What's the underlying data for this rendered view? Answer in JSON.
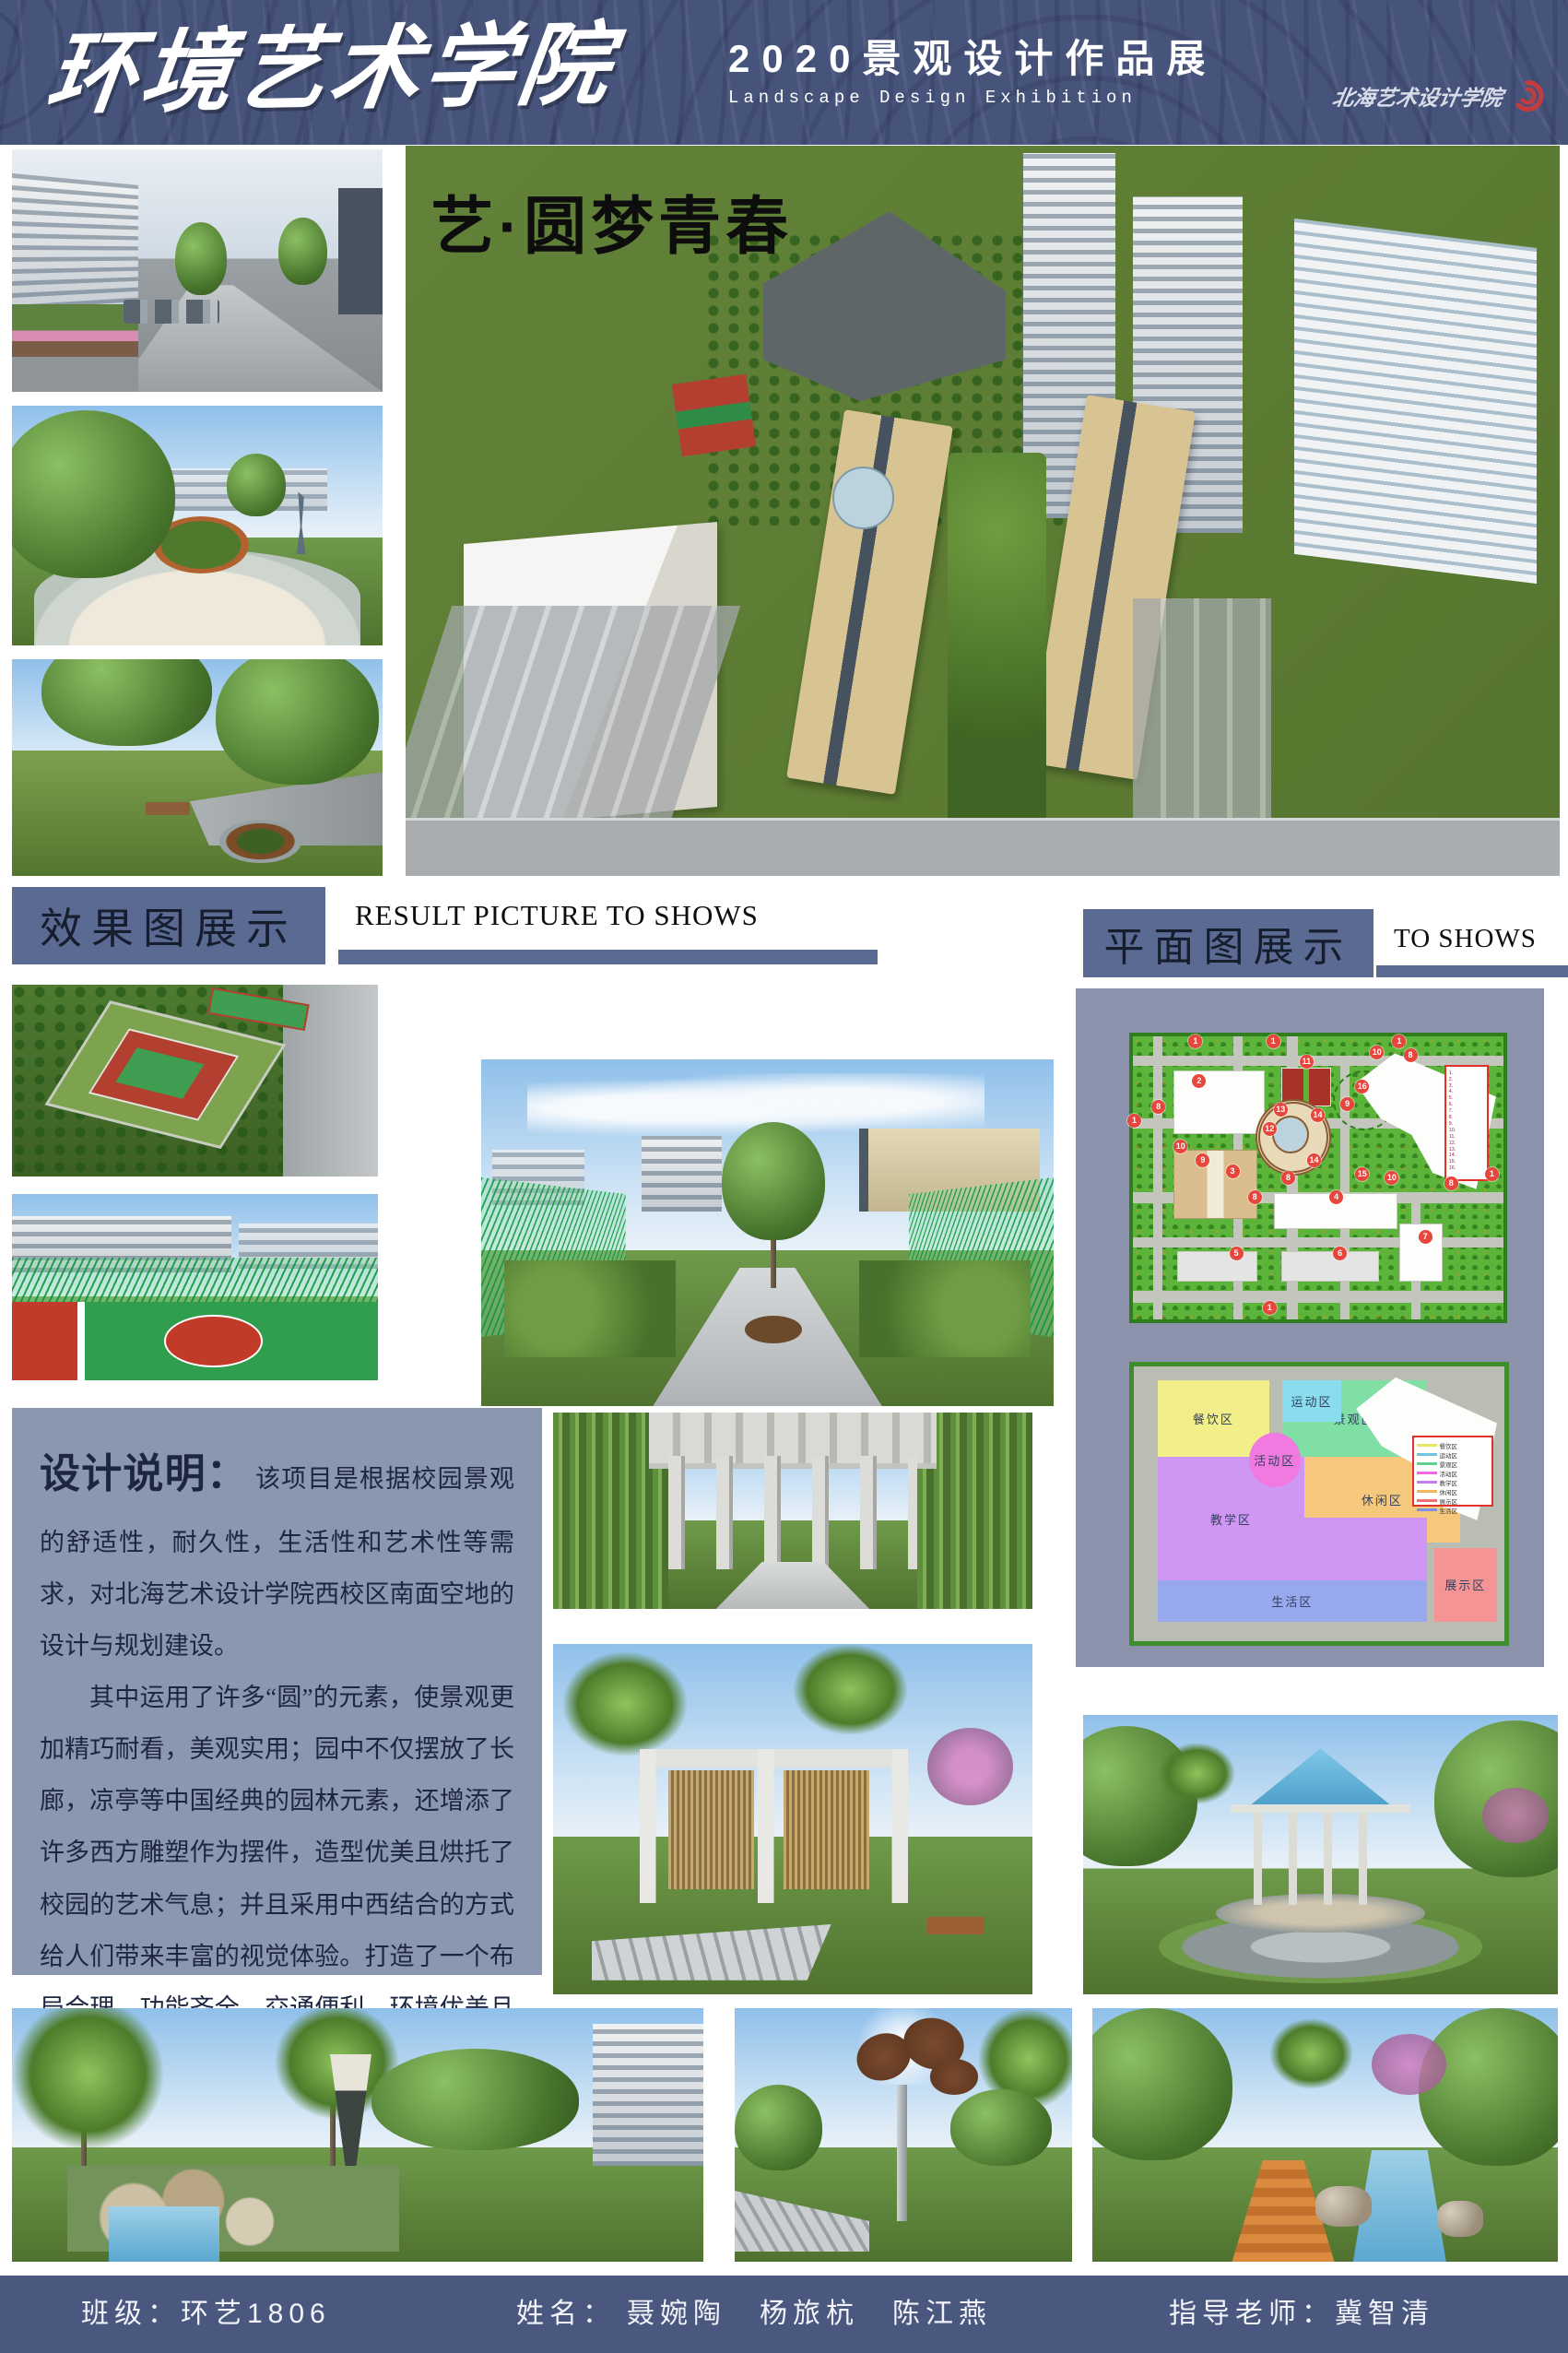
{
  "header": {
    "school_title": "环境艺术学院",
    "exhibition_title": "2020景观设计作品展",
    "exhibition_subtitle": "Landscape Design Exhibition",
    "seal_text": "北海艺术设计学院",
    "colors": {
      "background": "#46537b",
      "text": "#ffffff",
      "seal_red": "#c23b3f"
    }
  },
  "hero": {
    "slogan": "艺·圆梦青春"
  },
  "sections": {
    "results": {
      "title_cn": "效果图展示",
      "title_en": "RESULT PICTURE TO SHOWS"
    },
    "plans": {
      "title_cn": "平面图展示",
      "title_en": "TO SHOWS"
    },
    "accent_color": "#5a6a93"
  },
  "design_notes": {
    "heading": "设计说明：",
    "paragraphs": [
      "该项目是根据校园景观的舒适性，耐久性，生活性和艺术性等需求，对北海艺术设计学院西校区南面空地的设计与规划建设。",
      "其中运用了许多“圆”的元素，使景观更加精巧耐看，美观实用；园中不仅摆放了长廊，凉亭等中国经典的园林元素，还增添了许多西方雕塑作为摆件，造型优美且烘托了校园的艺术气息；并且采用中西结合的方式给人们带来丰富的视觉体验。打造了一个布局合理，功能齐全，交通便利，环境优美且充满艺术气息的校园景观。"
    ],
    "background": "#8b96b1"
  },
  "master_plan": {
    "marker_color": "#e8453c",
    "legend_numbers": [
      "1.",
      "2.",
      "3.",
      "4.",
      "5.",
      "6.",
      "7.",
      "8.",
      "9.",
      "10.",
      "11.",
      "12.",
      "13.",
      "14.",
      "15.",
      "16."
    ],
    "markers": [
      {
        "n": "1",
        "x": 17,
        "y": 2
      },
      {
        "n": "1",
        "x": 38,
        "y": 2
      },
      {
        "n": "1",
        "x": 72,
        "y": 2
      },
      {
        "n": "1",
        "x": 0.5,
        "y": 30
      },
      {
        "n": "1",
        "x": 97,
        "y": 49
      },
      {
        "n": "1",
        "x": 37,
        "y": 96
      },
      {
        "n": "2",
        "x": 18,
        "y": 16
      },
      {
        "n": "11",
        "x": 47,
        "y": 9
      },
      {
        "n": "10",
        "x": 66,
        "y": 6
      },
      {
        "n": "8",
        "x": 75,
        "y": 7
      },
      {
        "n": "16",
        "x": 62,
        "y": 18
      },
      {
        "n": "9",
        "x": 58,
        "y": 24
      },
      {
        "n": "8",
        "x": 7,
        "y": 25
      },
      {
        "n": "13",
        "x": 40,
        "y": 26
      },
      {
        "n": "14",
        "x": 50,
        "y": 28
      },
      {
        "n": "12",
        "x": 37,
        "y": 33
      },
      {
        "n": "14",
        "x": 49,
        "y": 44
      },
      {
        "n": "8",
        "x": 42,
        "y": 50
      },
      {
        "n": "15",
        "x": 62,
        "y": 49
      },
      {
        "n": "10",
        "x": 70,
        "y": 50
      },
      {
        "n": "10",
        "x": 13,
        "y": 39
      },
      {
        "n": "9",
        "x": 19,
        "y": 44
      },
      {
        "n": "3",
        "x": 27,
        "y": 48
      },
      {
        "n": "8",
        "x": 33,
        "y": 57
      },
      {
        "n": "4",
        "x": 55,
        "y": 57
      },
      {
        "n": "8",
        "x": 86,
        "y": 52
      },
      {
        "n": "7",
        "x": 79,
        "y": 71
      },
      {
        "n": "5",
        "x": 28,
        "y": 77
      },
      {
        "n": "6",
        "x": 56,
        "y": 77
      }
    ]
  },
  "zone_plan": {
    "zones": [
      {
        "name": "餐饮区",
        "color": "#f2ee8a",
        "x": 6.5,
        "y": 5,
        "w": 30,
        "h": 28
      },
      {
        "name": "景观区",
        "color": "#7fdfa4",
        "x": 40,
        "y": 5,
        "w": 39,
        "h": 28
      },
      {
        "name": "运动区",
        "color": "#8adcef",
        "x": 40,
        "y": 5,
        "w": 16,
        "h": 15
      },
      {
        "name": "休闲区",
        "color": "#f5c87e",
        "x": 46,
        "y": 33,
        "w": 42,
        "h": 31
      },
      {
        "name": "教学区",
        "color": "#d096f4",
        "x": 6.5,
        "y": 33,
        "w": 39.5,
        "h": 45
      },
      {
        "name": "",
        "color": "#d096f4",
        "x": 46,
        "y": 55,
        "w": 33,
        "h": 23
      },
      {
        "name": "生活区",
        "color": "#97a8ee",
        "x": 6.5,
        "y": 78,
        "w": 72.5,
        "h": 15
      },
      {
        "name": "展示区",
        "color": "#f49494",
        "x": 81,
        "y": 66,
        "w": 17,
        "h": 27
      },
      {
        "name": "活动区",
        "color": "#f07ae0",
        "x": 31,
        "y": 24,
        "w": 14,
        "h": 20,
        "cls": "round"
      }
    ],
    "legend": [
      {
        "label": "餐饮区",
        "color": "#e8e464"
      },
      {
        "label": "运动区",
        "color": "#6cc8e0"
      },
      {
        "label": "景观区",
        "color": "#5fd08e"
      },
      {
        "label": "活动区",
        "color": "#ee6ade"
      },
      {
        "label": "教学区",
        "color": "#c47df0"
      },
      {
        "label": "休闲区",
        "color": "#f0b860"
      },
      {
        "label": "展示区",
        "color": "#ee7070"
      },
      {
        "label": "生活区",
        "color": "#7e93e8"
      }
    ]
  },
  "footer": {
    "class_label": "班级：环艺1806",
    "name_label": "姓名：",
    "names": "聂婉陶　杨旅杭　陈江燕",
    "advisor_label": "指导老师：冀智清",
    "background": "#4a5880"
  }
}
